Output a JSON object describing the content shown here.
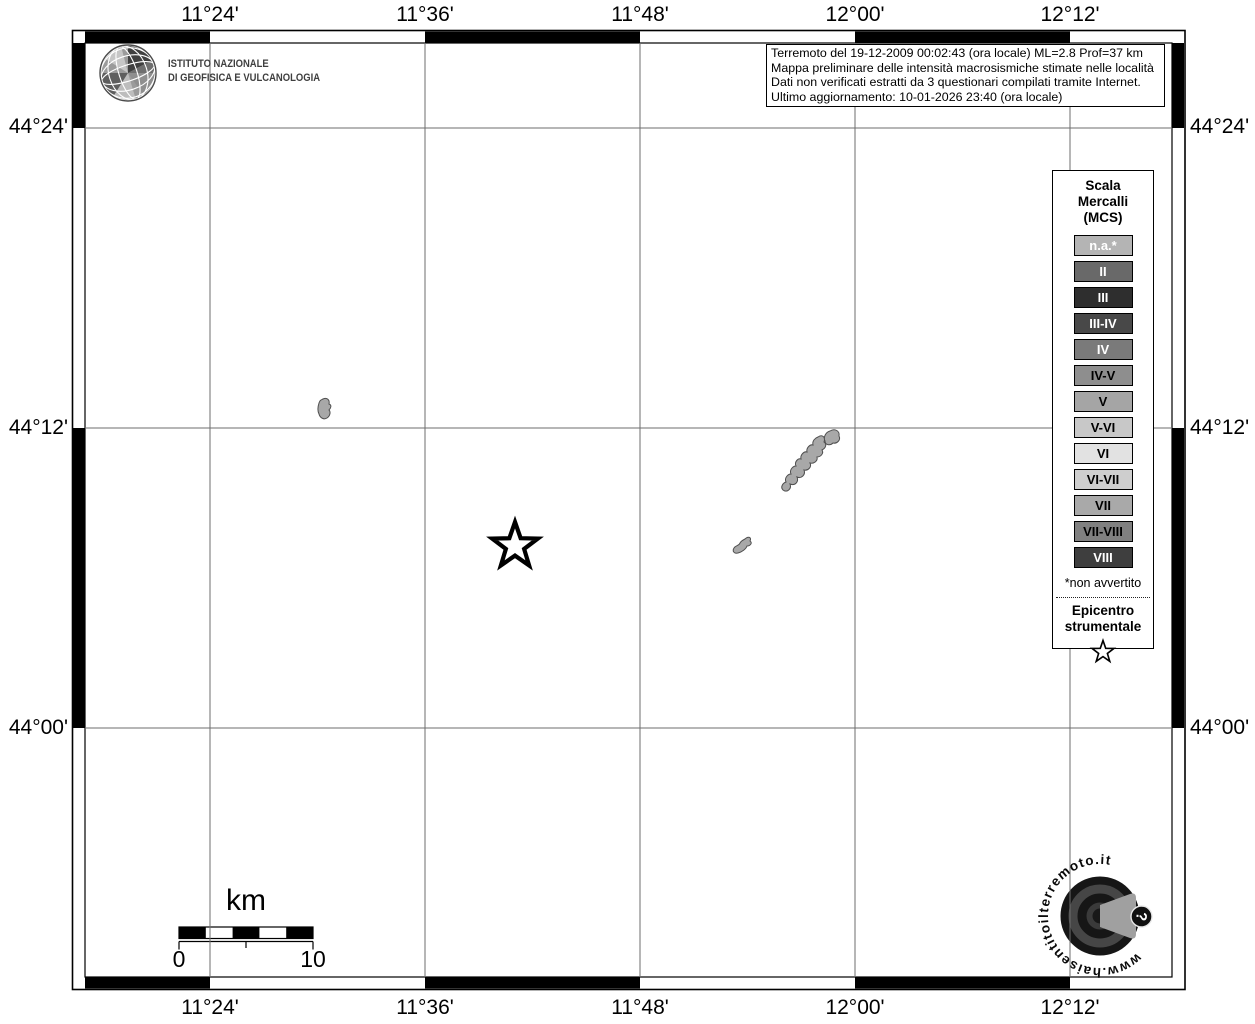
{
  "header": {
    "ingv": {
      "line1": "ISTITUTO NAZIONALE",
      "line2": "DI GEOFISICA E VULCANOLOGIA"
    },
    "info_box": {
      "lines": [
        "Terremoto del 19-12-2009 00:02:43 (ora locale) ML=2.8 Prof=37 km",
        "Mappa preliminare delle intensità macrosismiche stimate nelle località",
        "Dati non verificati estratti da 3 questionari compilati tramite Internet.",
        "Ultimo aggiornamento: 10-01-2026 23:40 (ora locale)"
      ]
    }
  },
  "map": {
    "axis": {
      "lon_labels": [
        "11°24'",
        "11°36'",
        "11°48'",
        "12°00'",
        "12°12'"
      ],
      "lat_labels": [
        "44°24'",
        "44°12'",
        "44°00'"
      ]
    },
    "scale_bar": {
      "unit_label": "km",
      "zero_label": "0",
      "end_label": "10"
    }
  },
  "legend": {
    "title_lines": [
      "Scala",
      "Mercalli",
      "(MCS)"
    ],
    "items": [
      {
        "label": "n.a.*",
        "color": "#b4b4b4",
        "text_color": "#ffffff"
      },
      {
        "label": "II",
        "color": "#696969",
        "text_color": "#ffffff"
      },
      {
        "label": "III",
        "color": "#2e2e2e",
        "text_color": "#ffffff"
      },
      {
        "label": "III-IV",
        "color": "#484848",
        "text_color": "#ffffff"
      },
      {
        "label": "IV",
        "color": "#7a7a7a",
        "text_color": "#ffffff"
      },
      {
        "label": "IV-V",
        "color": "#8e8e8e",
        "text_color": "#000000"
      },
      {
        "label": "V",
        "color": "#a5a5a5",
        "text_color": "#000000"
      },
      {
        "label": "V-VI",
        "color": "#c8c8c8",
        "text_color": "#000000"
      },
      {
        "label": "VI",
        "color": "#e2e2e2",
        "text_color": "#000000"
      },
      {
        "label": "VI-VII",
        "color": "#cecece",
        "text_color": "#000000"
      },
      {
        "label": "VII",
        "color": "#a9a9a9",
        "text_color": "#000000"
      },
      {
        "label": "VII-VIII",
        "color": "#808080",
        "text_color": "#000000"
      },
      {
        "label": "VIII",
        "color": "#3e3e3e",
        "text_color": "#ffffff"
      }
    ],
    "footnote": "*non avvertito",
    "epicenter_lines": [
      "Epicentro",
      "strumentale"
    ]
  },
  "watermark": {
    "text": "www.haisentitoilterremoto.it",
    "question_mark": "?"
  }
}
